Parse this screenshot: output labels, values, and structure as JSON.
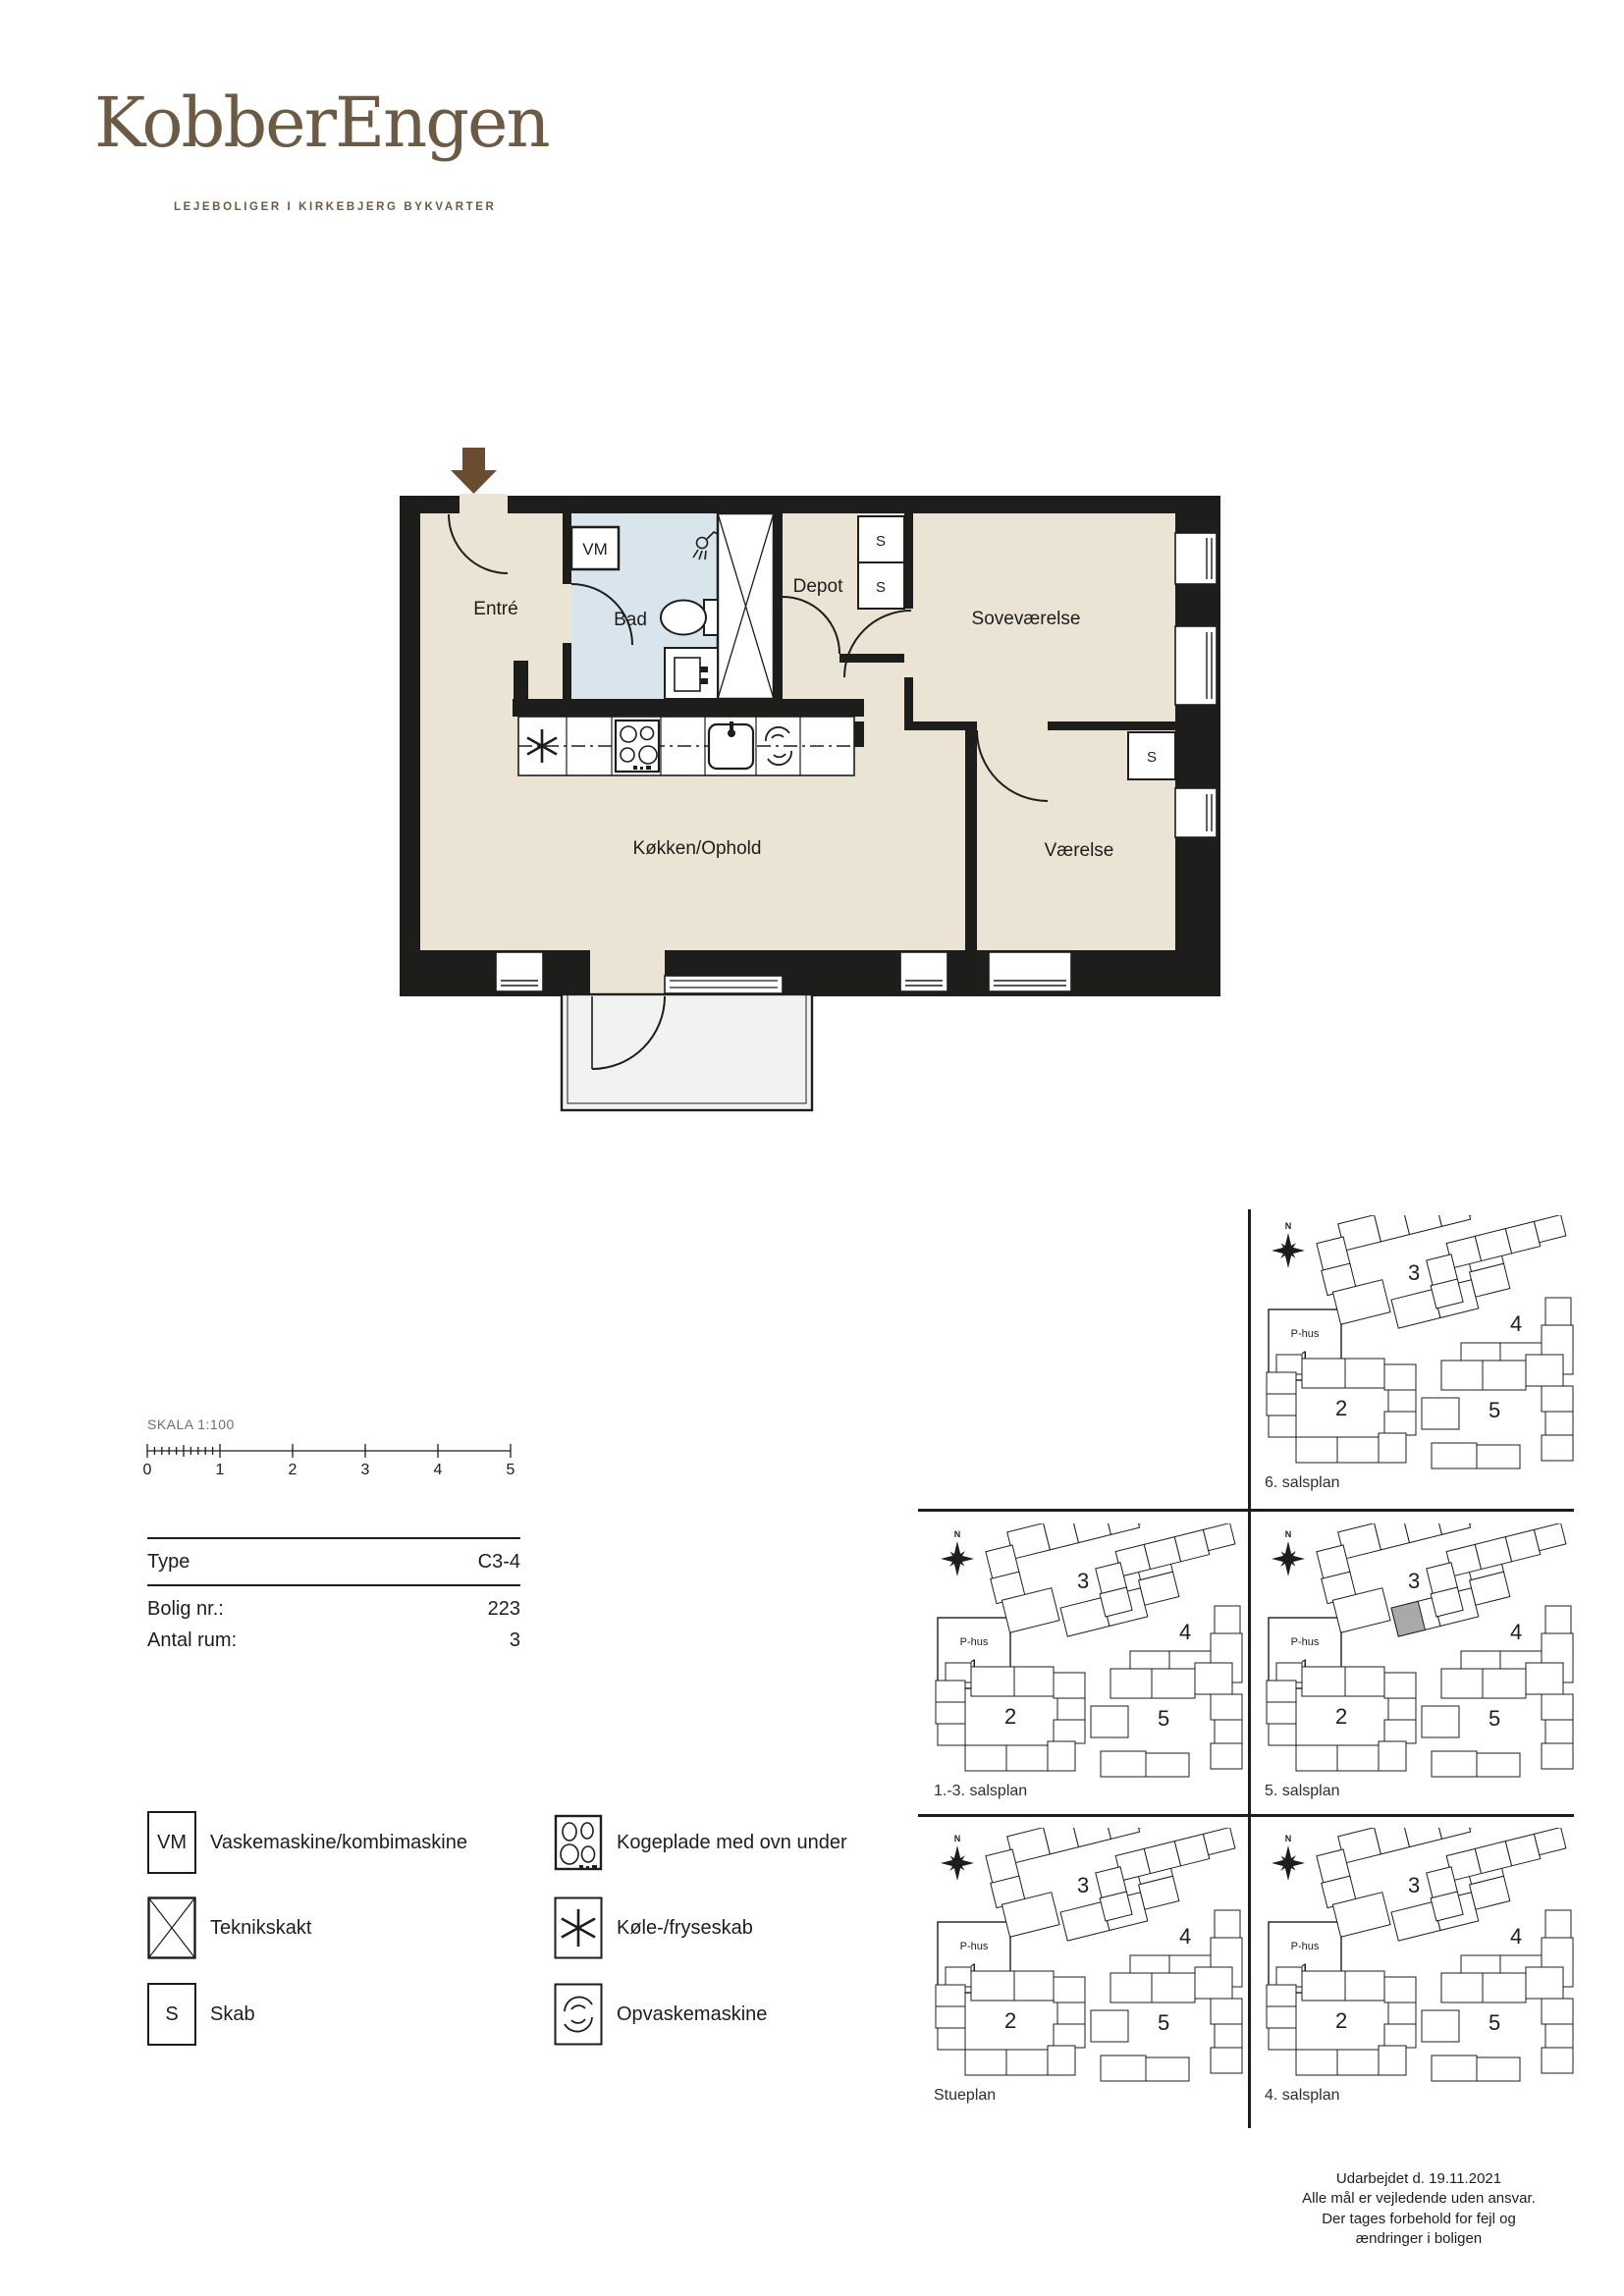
{
  "brand": {
    "logo": "KobberEngen",
    "tagline": "LEJEBOLIGER I KIRKEBJERG BYKVARTER"
  },
  "floor_plan": {
    "rooms": {
      "entre": "Entré",
      "bad": "Bad",
      "depot": "Depot",
      "sovevaerelse": "Soveværelse",
      "vaerelse": "Værelse",
      "kokken": "Køkken/Ophold"
    },
    "markers": {
      "vm": "VM",
      "s": "S"
    }
  },
  "scale": {
    "label": "SKALA 1:100",
    "ticks": [
      "0",
      "1",
      "2",
      "3",
      "4",
      "5"
    ]
  },
  "info": {
    "rows": [
      {
        "label": "Type",
        "value": "C3-4"
      },
      {
        "label": "Bolig nr.:",
        "value": "223"
      },
      {
        "label": "Antal rum:",
        "value": "3"
      }
    ]
  },
  "legend": {
    "left": [
      {
        "symbol": "VM",
        "label": "Vaskemaskine/kombimaskine"
      },
      {
        "symbol": "X",
        "label": "Teknikskakt"
      },
      {
        "symbol": "S",
        "label": "Skab"
      }
    ],
    "right": [
      {
        "symbol": "cooktop",
        "label": "Kogeplade med ovn under"
      },
      {
        "symbol": "fridge",
        "label": "Køle-/fryseskab"
      },
      {
        "symbol": "dishwasher",
        "label": "Opvaskemaskine"
      }
    ]
  },
  "site_plans": {
    "compass": "N",
    "phus": {
      "line1": "P-hus",
      "line2": "1"
    },
    "buildings": [
      "2",
      "3",
      "4",
      "5"
    ],
    "plans": [
      {
        "label": "6. salsplan",
        "highlight": false
      },
      {
        "label": "1.-3. salsplan",
        "highlight": false
      },
      {
        "label": "5. salsplan",
        "highlight": true
      },
      {
        "label": "Stueplan",
        "highlight": false
      },
      {
        "label": "4. salsplan",
        "highlight": false
      }
    ]
  },
  "footer": {
    "lines": [
      "Udarbejdet d. 19.11.2021",
      "Alle mål er vejledende uden ansvar.",
      "Der tages forbehold for fejl og",
      "ændringer i boligen"
    ]
  },
  "colors": {
    "brand_brown": "#6d5a45",
    "arrow_brown": "#6a4c31",
    "wall": "#1d1d1b",
    "floor": "#ebe3d3",
    "bath": "#d9e5ec",
    "balcony": "#f2f2f0",
    "highlight": "#a9a9a9"
  }
}
